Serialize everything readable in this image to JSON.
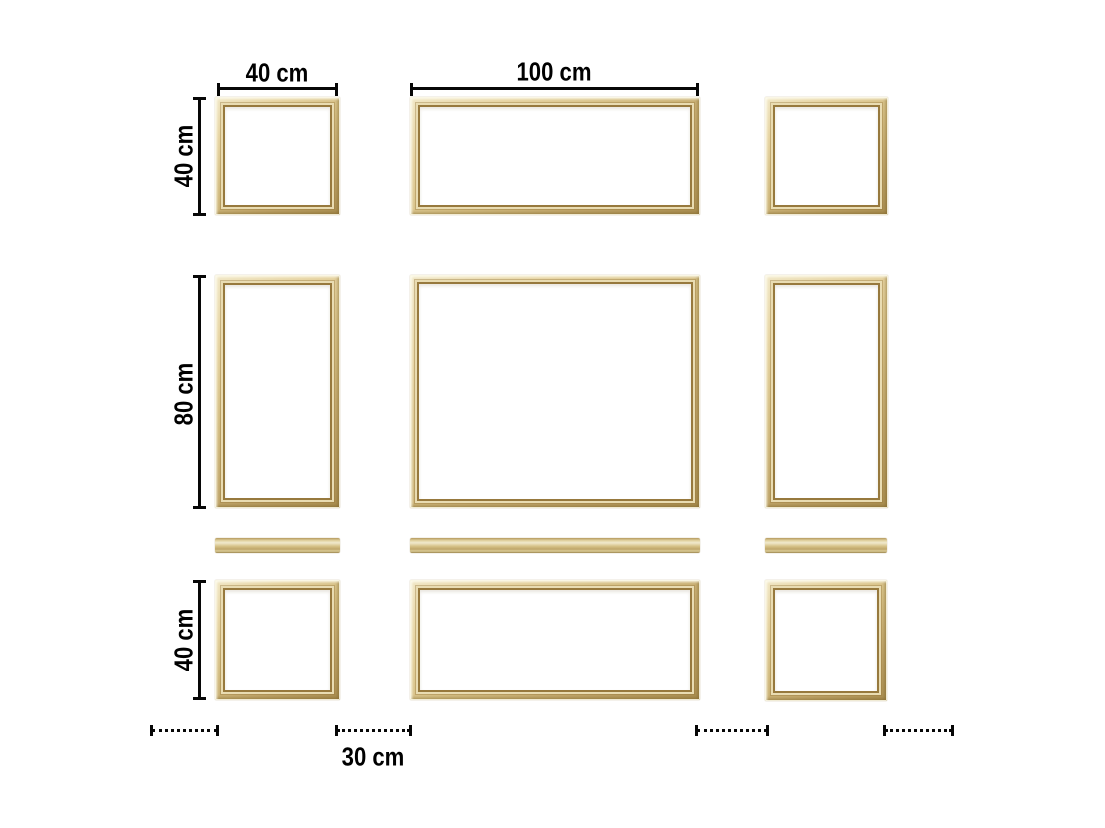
{
  "diagram": {
    "description": "Wall layout of gold picture-frame mouldings with dimension annotations",
    "labels": {
      "top_left_width": "40 cm",
      "top_center_width": "100 cm",
      "left_top_height": "40 cm",
      "left_middle_height": "80 cm",
      "left_bottom_height": "40 cm",
      "bottom_spacing": "30 cm"
    },
    "colors": {
      "background": "#ffffff",
      "annotation": "#000000",
      "frame_gold_light": "#f1e7c6",
      "frame_gold_mid": "#d3bc80",
      "frame_gold_dark": "#aa8e50"
    }
  }
}
